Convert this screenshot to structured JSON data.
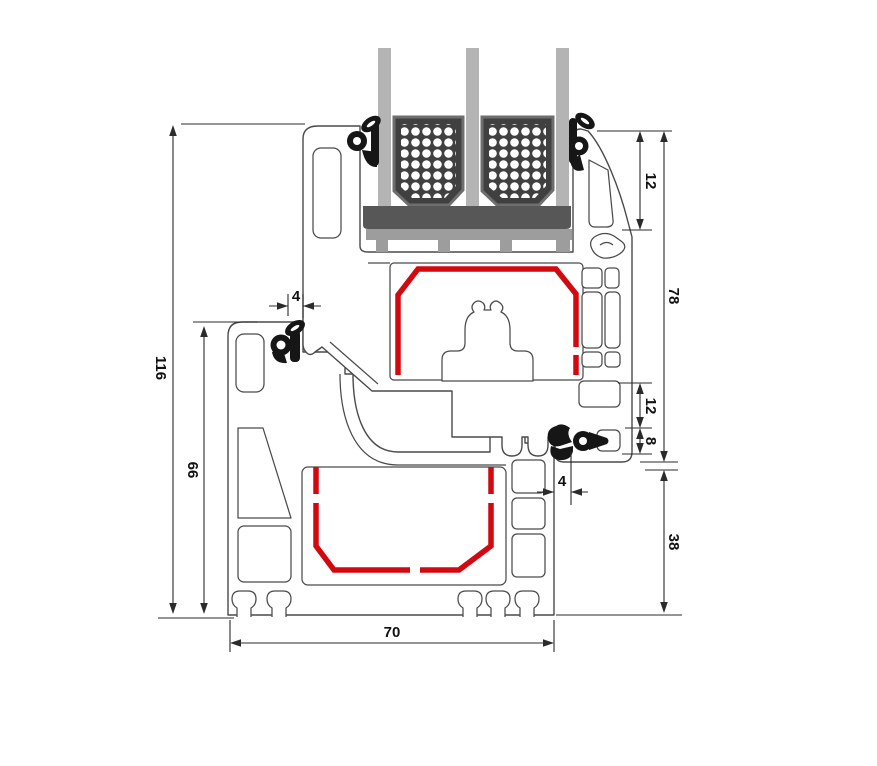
{
  "drawing": {
    "type": "window-profile-cross-section",
    "dimensions": {
      "overall_height": "116",
      "frame_height": "66",
      "gasket_clearance_top": "4",
      "glazing_overlap": "12",
      "sash_height": "78",
      "rebate_height": "12",
      "rebate_lip": "8",
      "gasket_clearance_bottom": "4",
      "frame_face_height": "38",
      "profile_depth": "70"
    },
    "colors": {
      "background": "#ffffff",
      "profile_outline": "#4a4a4a",
      "steel_reinforcement": "#d20a10",
      "gasket": "#161616",
      "gasket_hole": "#ffffff",
      "glass": "#b4b4b4",
      "spacer_block": "#404040",
      "spacer_border": "#6e6e6e",
      "spacer_dots": "#ffffff",
      "setting_block": "#575757",
      "glazing_bridge": "#9d9d9d",
      "dimension_line": "#2b2b2b",
      "dimension_text": "#111111"
    }
  }
}
